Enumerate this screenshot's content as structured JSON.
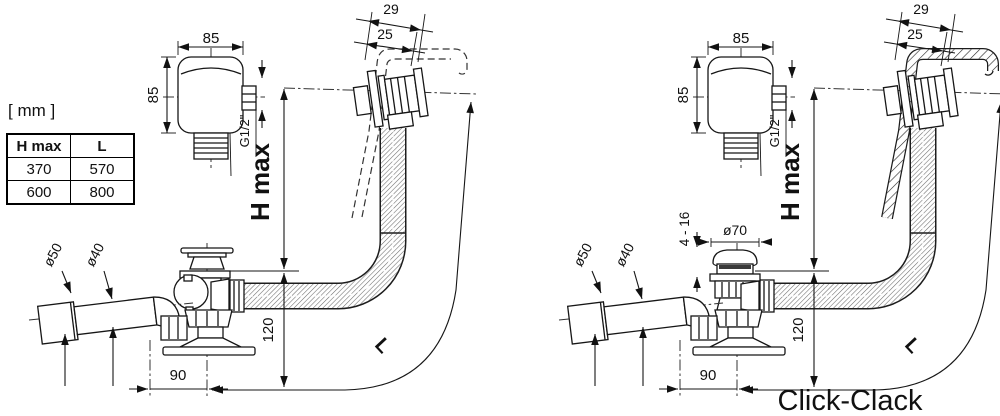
{
  "units_label": "[ mm ]",
  "table": {
    "headers": [
      "H max",
      "L"
    ],
    "rows": [
      [
        "370",
        "570"
      ],
      [
        "600",
        "800"
      ]
    ]
  },
  "colors": {
    "line": "#161616",
    "accent_red": "#e5231b"
  },
  "diagrams": [
    {
      "name": "standard-waste-and-overflow",
      "variant_label": "",
      "dims": {
        "overflow_width": "85",
        "overflow_height": "85",
        "thread": "G1/2\"",
        "rim_total": "29",
        "rim_inner": "25",
        "h_max": "H max",
        "length": "L",
        "outlet_outer": "ø50",
        "outlet_inner": "ø40",
        "drain_offset": "90",
        "drain_height": "120"
      }
    },
    {
      "name": "click-clack-waste-and-overflow",
      "variant_label": "Click-Clack",
      "dims": {
        "overflow_width": "85",
        "overflow_height": "85",
        "thread": "G1/2\"",
        "rim_total": "29",
        "rim_inner": "25",
        "h_max": "H max",
        "length": "L",
        "outlet_outer": "ø50",
        "outlet_inner": "ø40",
        "drain_offset": "90",
        "drain_height": "120",
        "plug_diameter": "ø70",
        "plug_travel": "4 - 16"
      }
    }
  ]
}
